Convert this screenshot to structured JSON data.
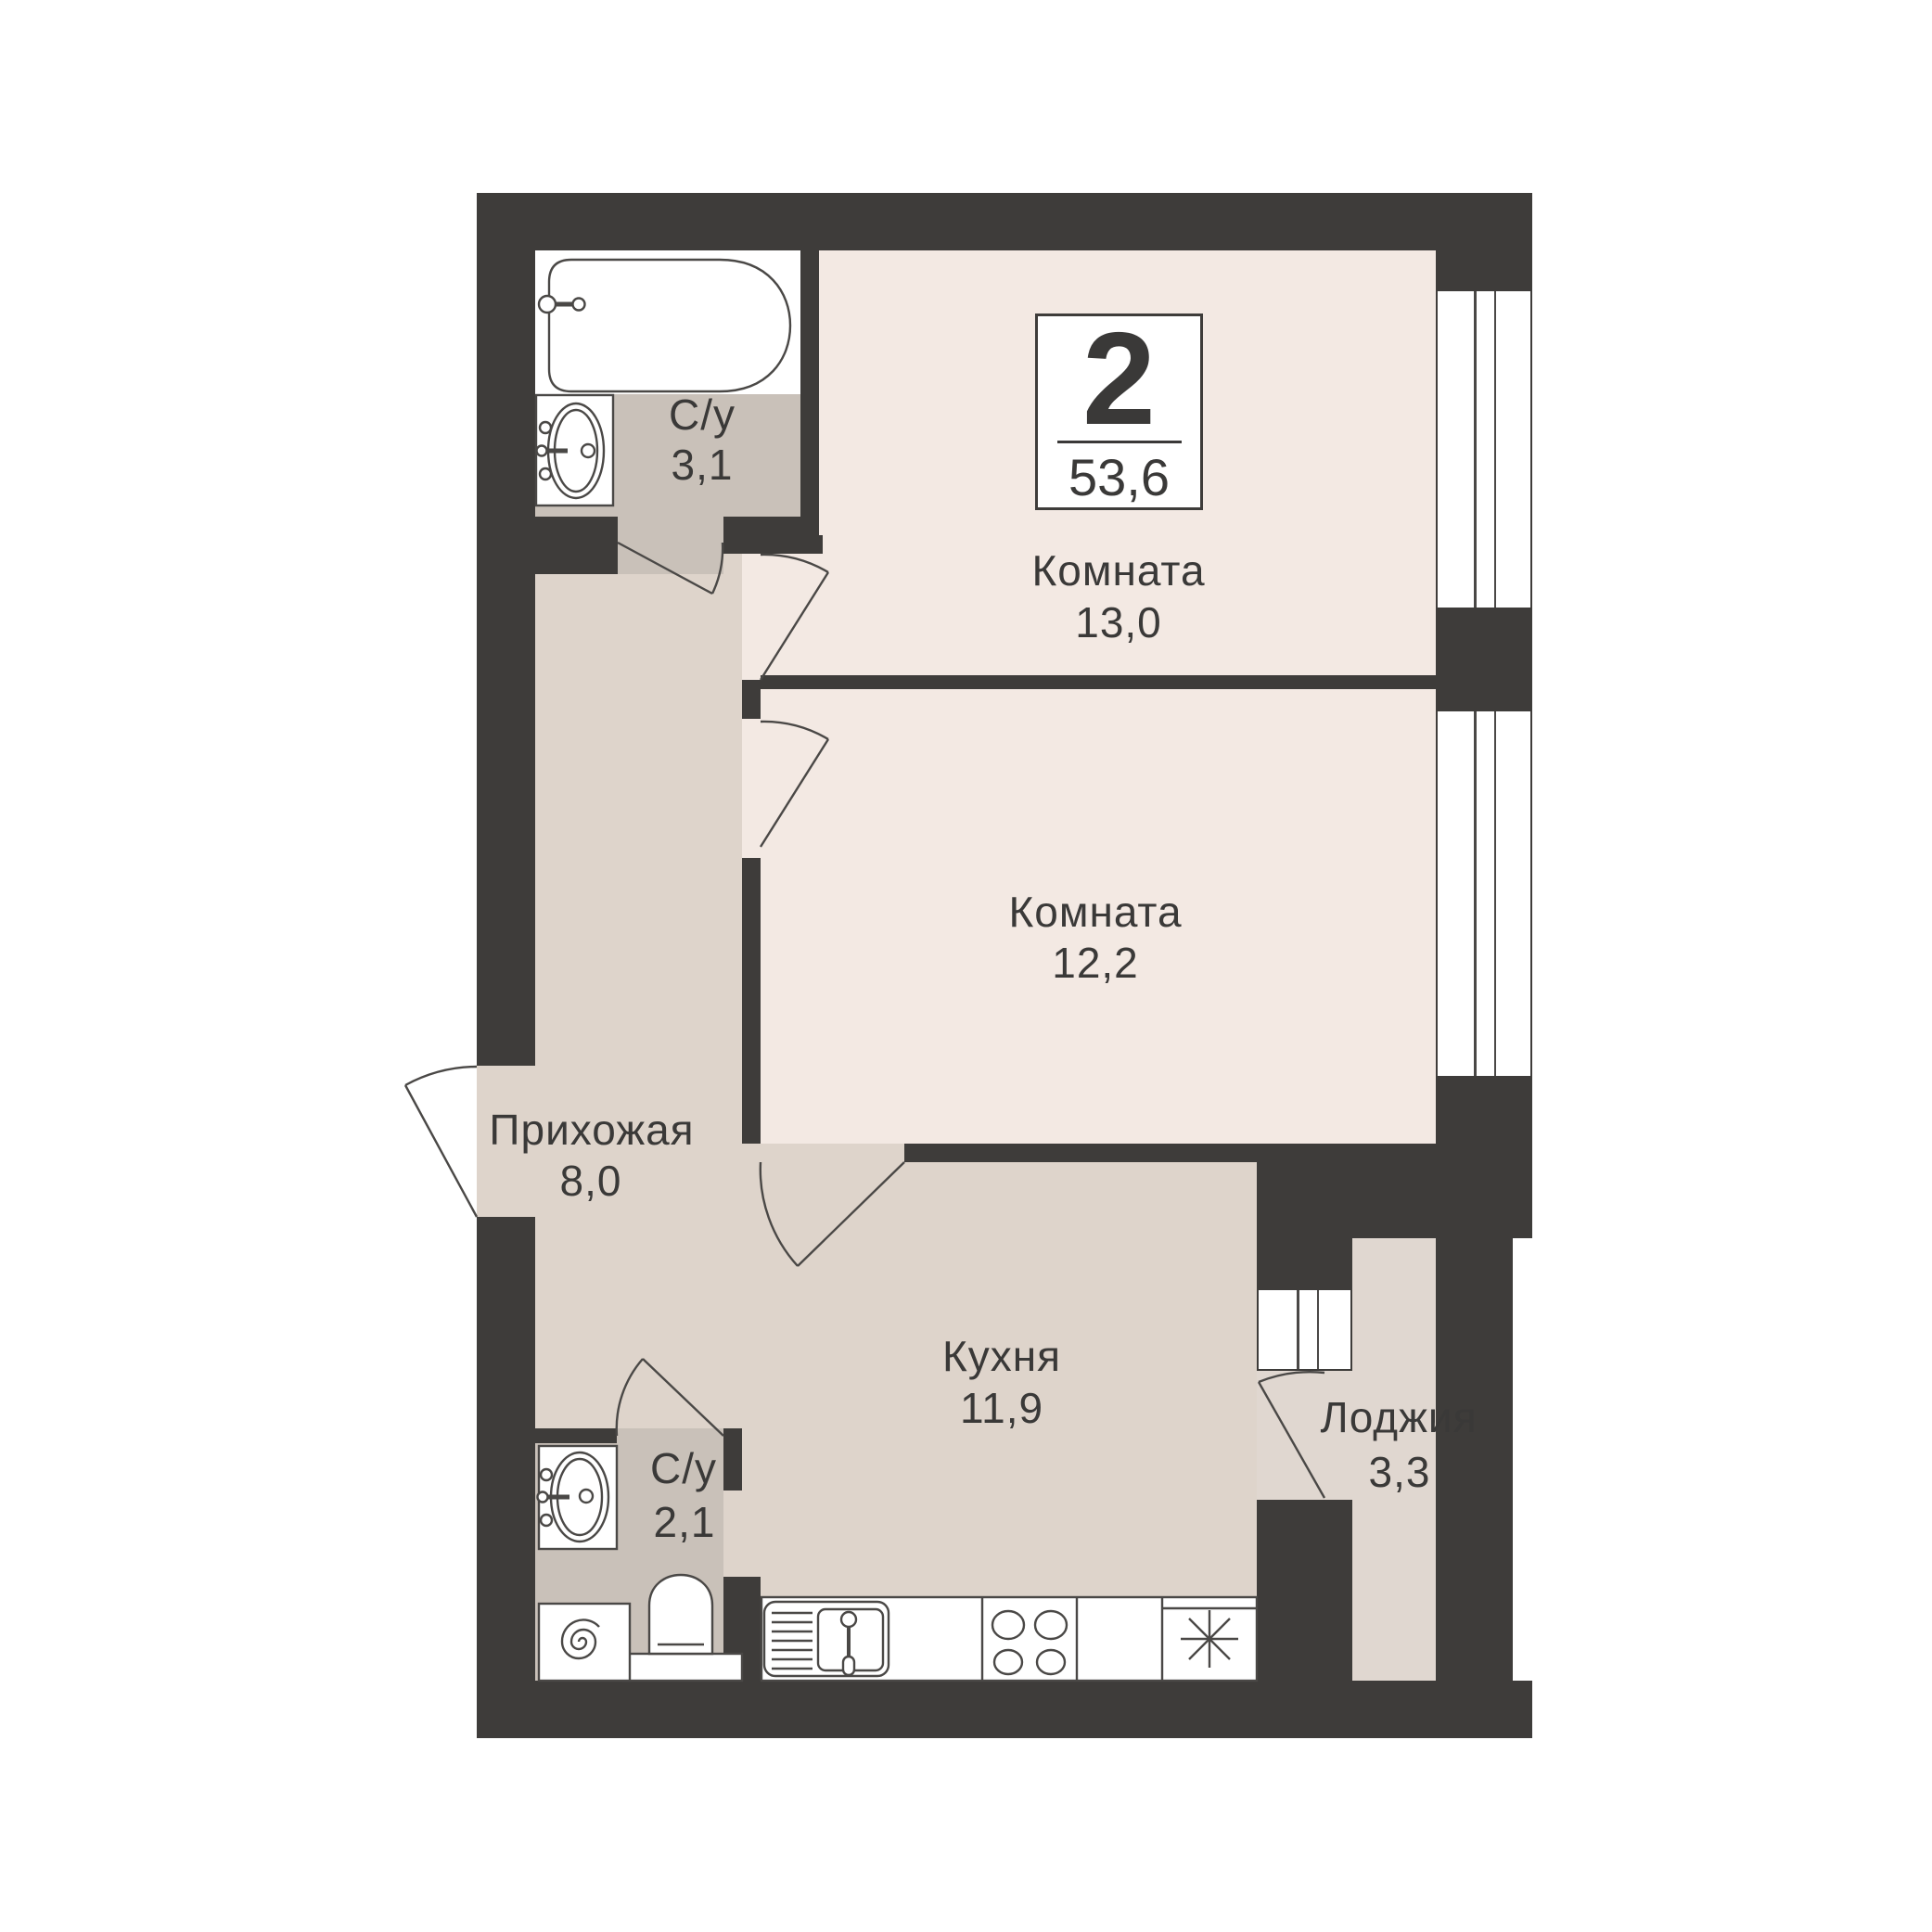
{
  "title": "2-room apartment floor plan",
  "badge": {
    "rooms_count": "2",
    "total_area": "53,6"
  },
  "rooms": [
    {
      "key": "room1",
      "label": "Комната",
      "area": "13,0"
    },
    {
      "key": "room2",
      "label": "Комната",
      "area": "12,2"
    },
    {
      "key": "hallway",
      "label": "Прихожая",
      "area": "8,0"
    },
    {
      "key": "kitchen",
      "label": "Кухня",
      "area": "11,9"
    },
    {
      "key": "loggia",
      "label": "Лоджия",
      "area": "3,3"
    },
    {
      "key": "bathroom_top",
      "label": "С/у",
      "area": "3,1"
    },
    {
      "key": "bathroom_bottom",
      "label": "С/у",
      "area": "2,1"
    }
  ],
  "fixtures": [
    "bathtub-icon",
    "sink-icon",
    "sink-icon",
    "toilet-icon",
    "washing-machine-icon",
    "kitchen-sink-icon",
    "stove-icon",
    "fridge-snowflake-icon"
  ],
  "colors": {
    "wall": "#3e3c3a",
    "room": "#f3e9e3",
    "hall": "#ded4cb",
    "bath": "#c9c1b9",
    "loggia": "#e0d7d0",
    "line": "#4a4846",
    "text": "#3a3938",
    "white": "#ffffff"
  }
}
